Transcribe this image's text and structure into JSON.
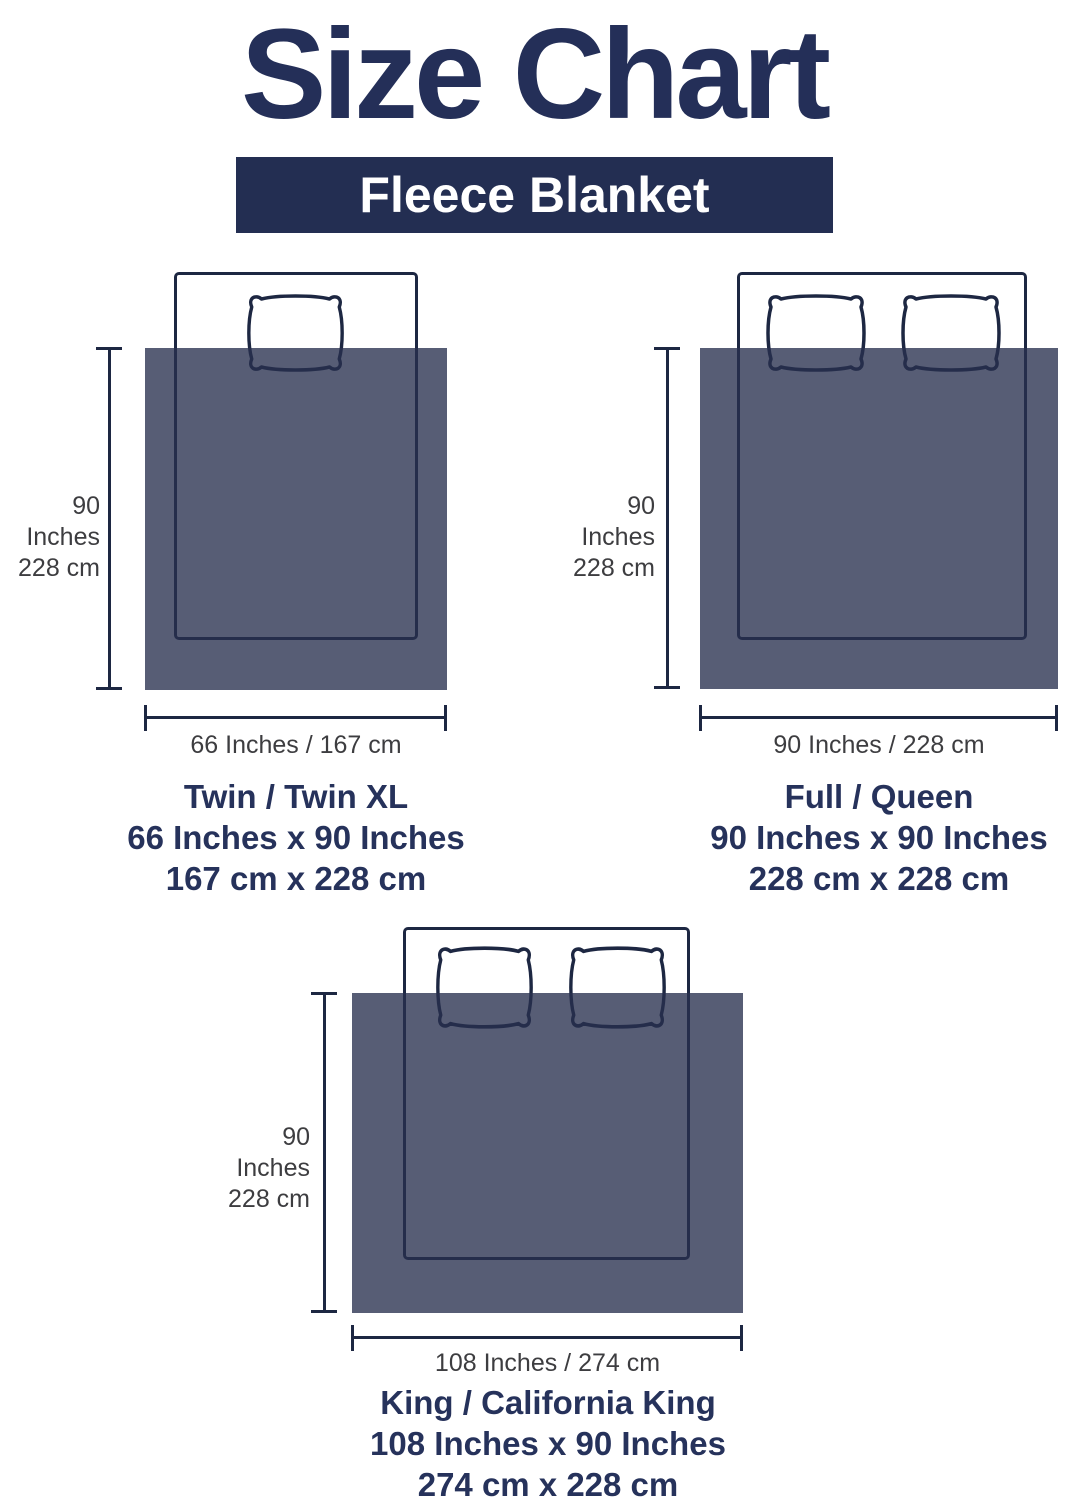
{
  "title": "Size Chart",
  "banner": {
    "label": "Fleece Blanket"
  },
  "colors": {
    "navy_text": "#242f58",
    "banner_background": "#232e52",
    "outline": "#1d2742",
    "blanket_fill": "rgba(40,48,78,0.78)",
    "dimension_text": "#3d3d40"
  },
  "sizes": [
    {
      "name": "Twin / Twin XL",
      "dimensions_inches": "66 Inches x 90 Inches",
      "dimensions_cm": "167 cm x 228 cm",
      "width_label": "66 Inches / 167 cm",
      "height_label_inches": "90 Inches",
      "height_label_cm": "228 cm",
      "pillow_count": 1
    },
    {
      "name": "Full / Queen",
      "dimensions_inches": "90 Inches x 90 Inches",
      "dimensions_cm": "228 cm x 228 cm",
      "width_label": "90 Inches / 228 cm",
      "height_label_inches": "90 Inches",
      "height_label_cm": "228 cm",
      "pillow_count": 2
    },
    {
      "name": "King / California King",
      "dimensions_inches": "108 Inches x 90 Inches",
      "dimensions_cm": "274 cm x 228 cm",
      "width_label": "108 Inches / 274 cm",
      "height_label_inches": "90 Inches",
      "height_label_cm": "228 cm",
      "pillow_count": 2
    }
  ]
}
